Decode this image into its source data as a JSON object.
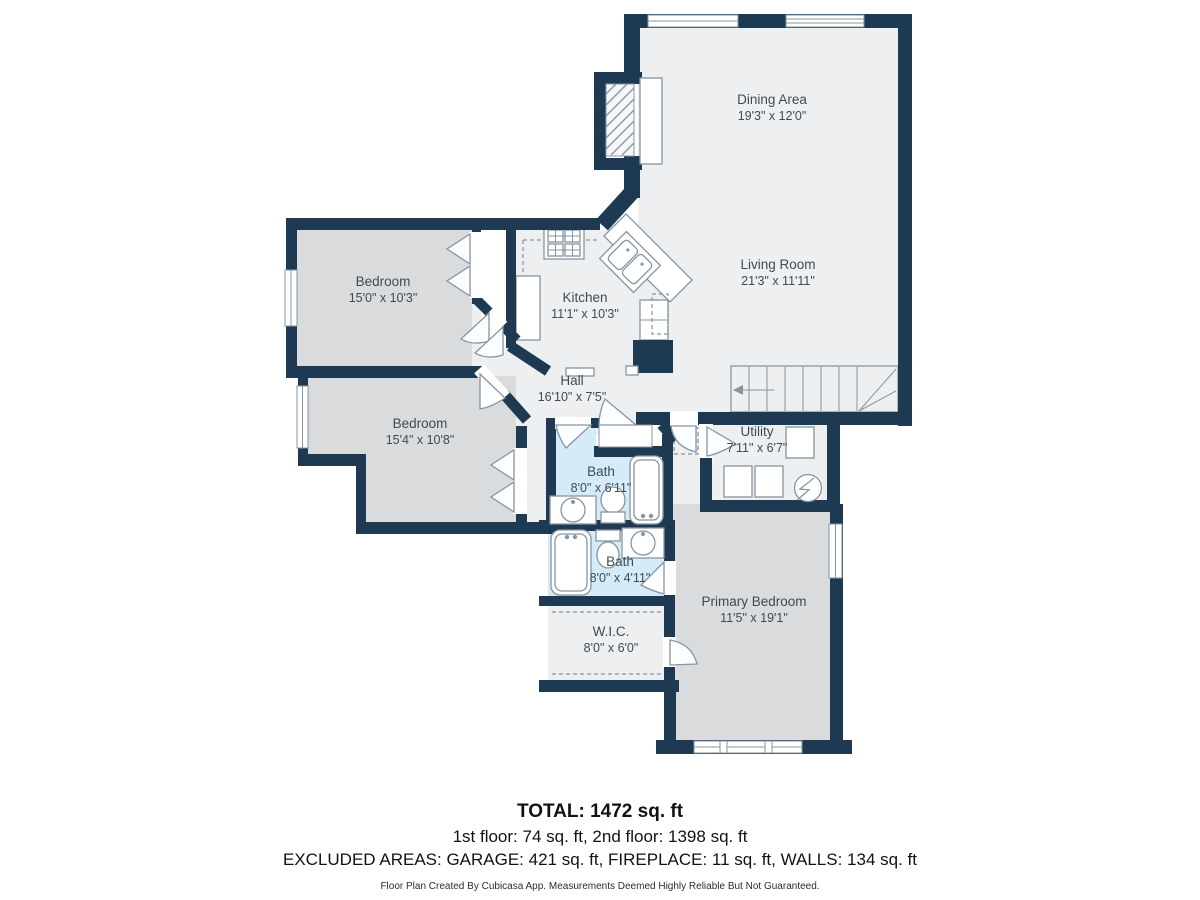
{
  "plan": {
    "rooms": [
      {
        "id": "dining",
        "name": "Dining Area",
        "dims": "19'3\" x 12'0\""
      },
      {
        "id": "living",
        "name": "Living Room",
        "dims": "21'3\" x 11'11\""
      },
      {
        "id": "kitchen",
        "name": "Kitchen",
        "dims": "11'1\" x 10'3\""
      },
      {
        "id": "hall",
        "name": "Hall",
        "dims": "16'10\" x 7'5\""
      },
      {
        "id": "bedroom1",
        "name": "Bedroom",
        "dims": "15'0\" x 10'3\""
      },
      {
        "id": "bedroom2",
        "name": "Bedroom",
        "dims": "15'4\" x 10'8\""
      },
      {
        "id": "bath1",
        "name": "Bath",
        "dims": "8'0\" x 6'11\""
      },
      {
        "id": "bath2",
        "name": "Bath",
        "dims": "8'0\" x 4'11\""
      },
      {
        "id": "utility",
        "name": "Utility",
        "dims": "7'11\" x 6'7\""
      },
      {
        "id": "primary",
        "name": "Primary Bedroom",
        "dims": "11'5\" x 19'1\""
      },
      {
        "id": "wic",
        "name": "W.I.C.",
        "dims": "8'0\" x 6'0\""
      }
    ],
    "colors": {
      "wall": "#1e3a52",
      "room_light": "#edeff1",
      "room_gray": "#d9dbdd",
      "bath_blue": "#d6ebf8",
      "fixture_line": "#8795a1",
      "label_text": "#3d4b58"
    }
  },
  "footer": {
    "total": "TOTAL: 1472 sq. ft",
    "floors": "1st floor: 74 sq. ft, 2nd floor: 1398 sq. ft",
    "excluded": "EXCLUDED AREAS: GARAGE: 421 sq. ft, FIREPLACE: 11 sq. ft, WALLS: 134 sq. ft",
    "disclaimer": "Floor Plan Created By Cubicasa App. Measurements Deemed Highly Reliable But Not Guaranteed."
  }
}
